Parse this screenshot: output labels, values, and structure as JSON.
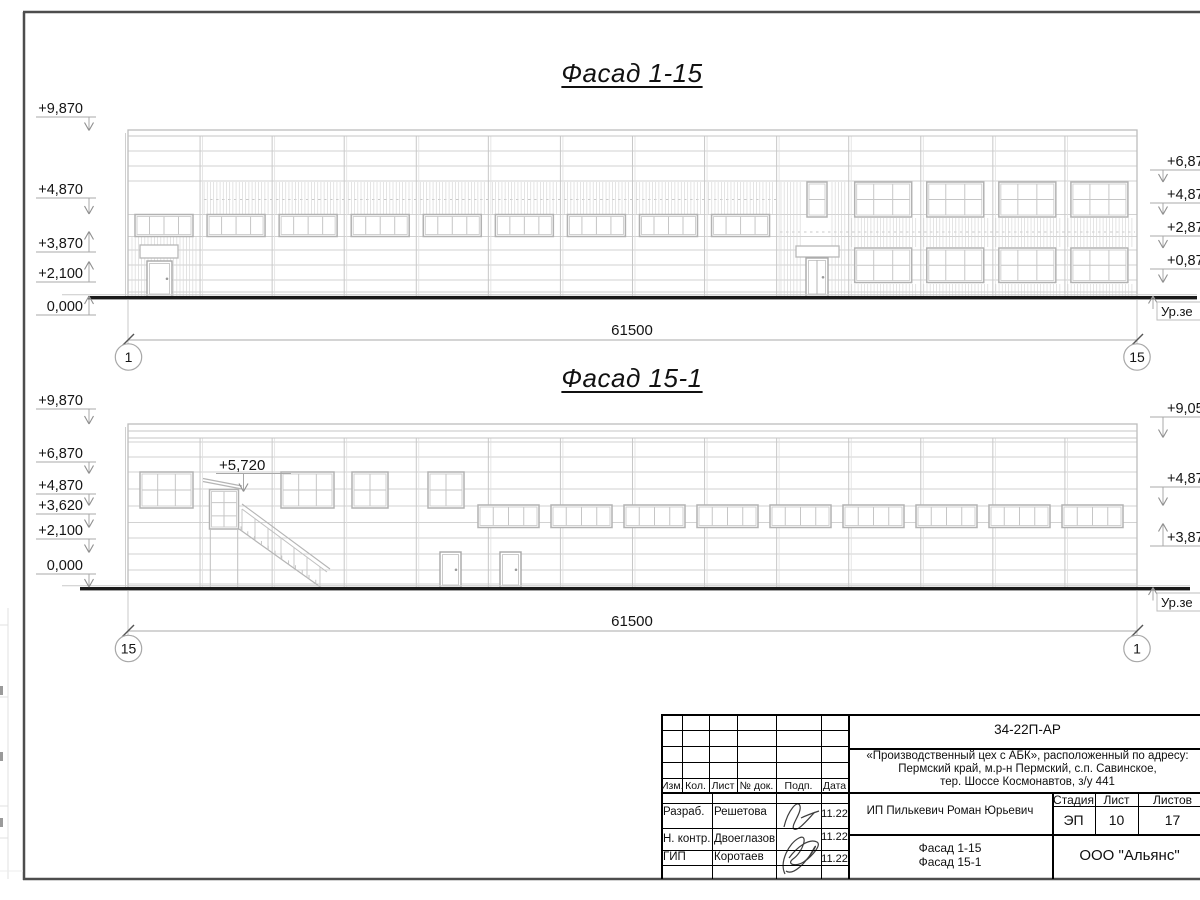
{
  "facade1": {
    "title": "Фасад 1-15",
    "left_marks": [
      "+9,870",
      "+4,870",
      "+3,870",
      "+2,100",
      "0,000"
    ],
    "right_marks": [
      "+6,87",
      "+4,87",
      "+2,87",
      "+0,87"
    ],
    "ground_label": "Ур.зе",
    "dimension": "61500",
    "axis_left": "1",
    "axis_right": "15"
  },
  "facade2": {
    "title": "Фасад 15-1",
    "left_marks": [
      "+9,870",
      "+6,870",
      "+4,870",
      "+3,620",
      "+2,100",
      "0,000"
    ],
    "stair_mark": "+5,720",
    "right_marks": [
      "+9,05",
      "+4,87",
      "+3,87"
    ],
    "ground_label": "Ур.зе",
    "dimension": "61500",
    "axis_left": "15",
    "axis_right": "1"
  },
  "title_block": {
    "doc_number": "34-22П-АР",
    "project_lines": [
      "«Производственный цех с АБК», расположенный по адресу:",
      "Пермский край, м.р-н Пермский, с.п. Савинское,",
      "тер. Шоссе Космонавтов, з/у 441"
    ],
    "columns": [
      "Изм.",
      "Кол.",
      "Лист",
      "№ док.",
      "Подп.",
      "Дата"
    ],
    "signature_rows": [
      {
        "role": "Разраб.",
        "name": "Решетова",
        "date": "11.22"
      },
      {
        "role": "Н. контр.",
        "name": "Двоеглазов",
        "date": "11.22"
      },
      {
        "role": "ГИП",
        "name": "Коротаев",
        "date": "11.22"
      }
    ],
    "client": "ИП Пилькевич Роман Юрьевич",
    "stage_label": "Стадия",
    "sheet_label": "Лист",
    "sheets_label": "Листов",
    "stage": "ЭП",
    "sheet": "10",
    "sheets": "17",
    "drawing_titles": [
      "Фасад 1-15",
      "Фасад 15-1"
    ],
    "organization": "ООО \"Альянс\""
  }
}
